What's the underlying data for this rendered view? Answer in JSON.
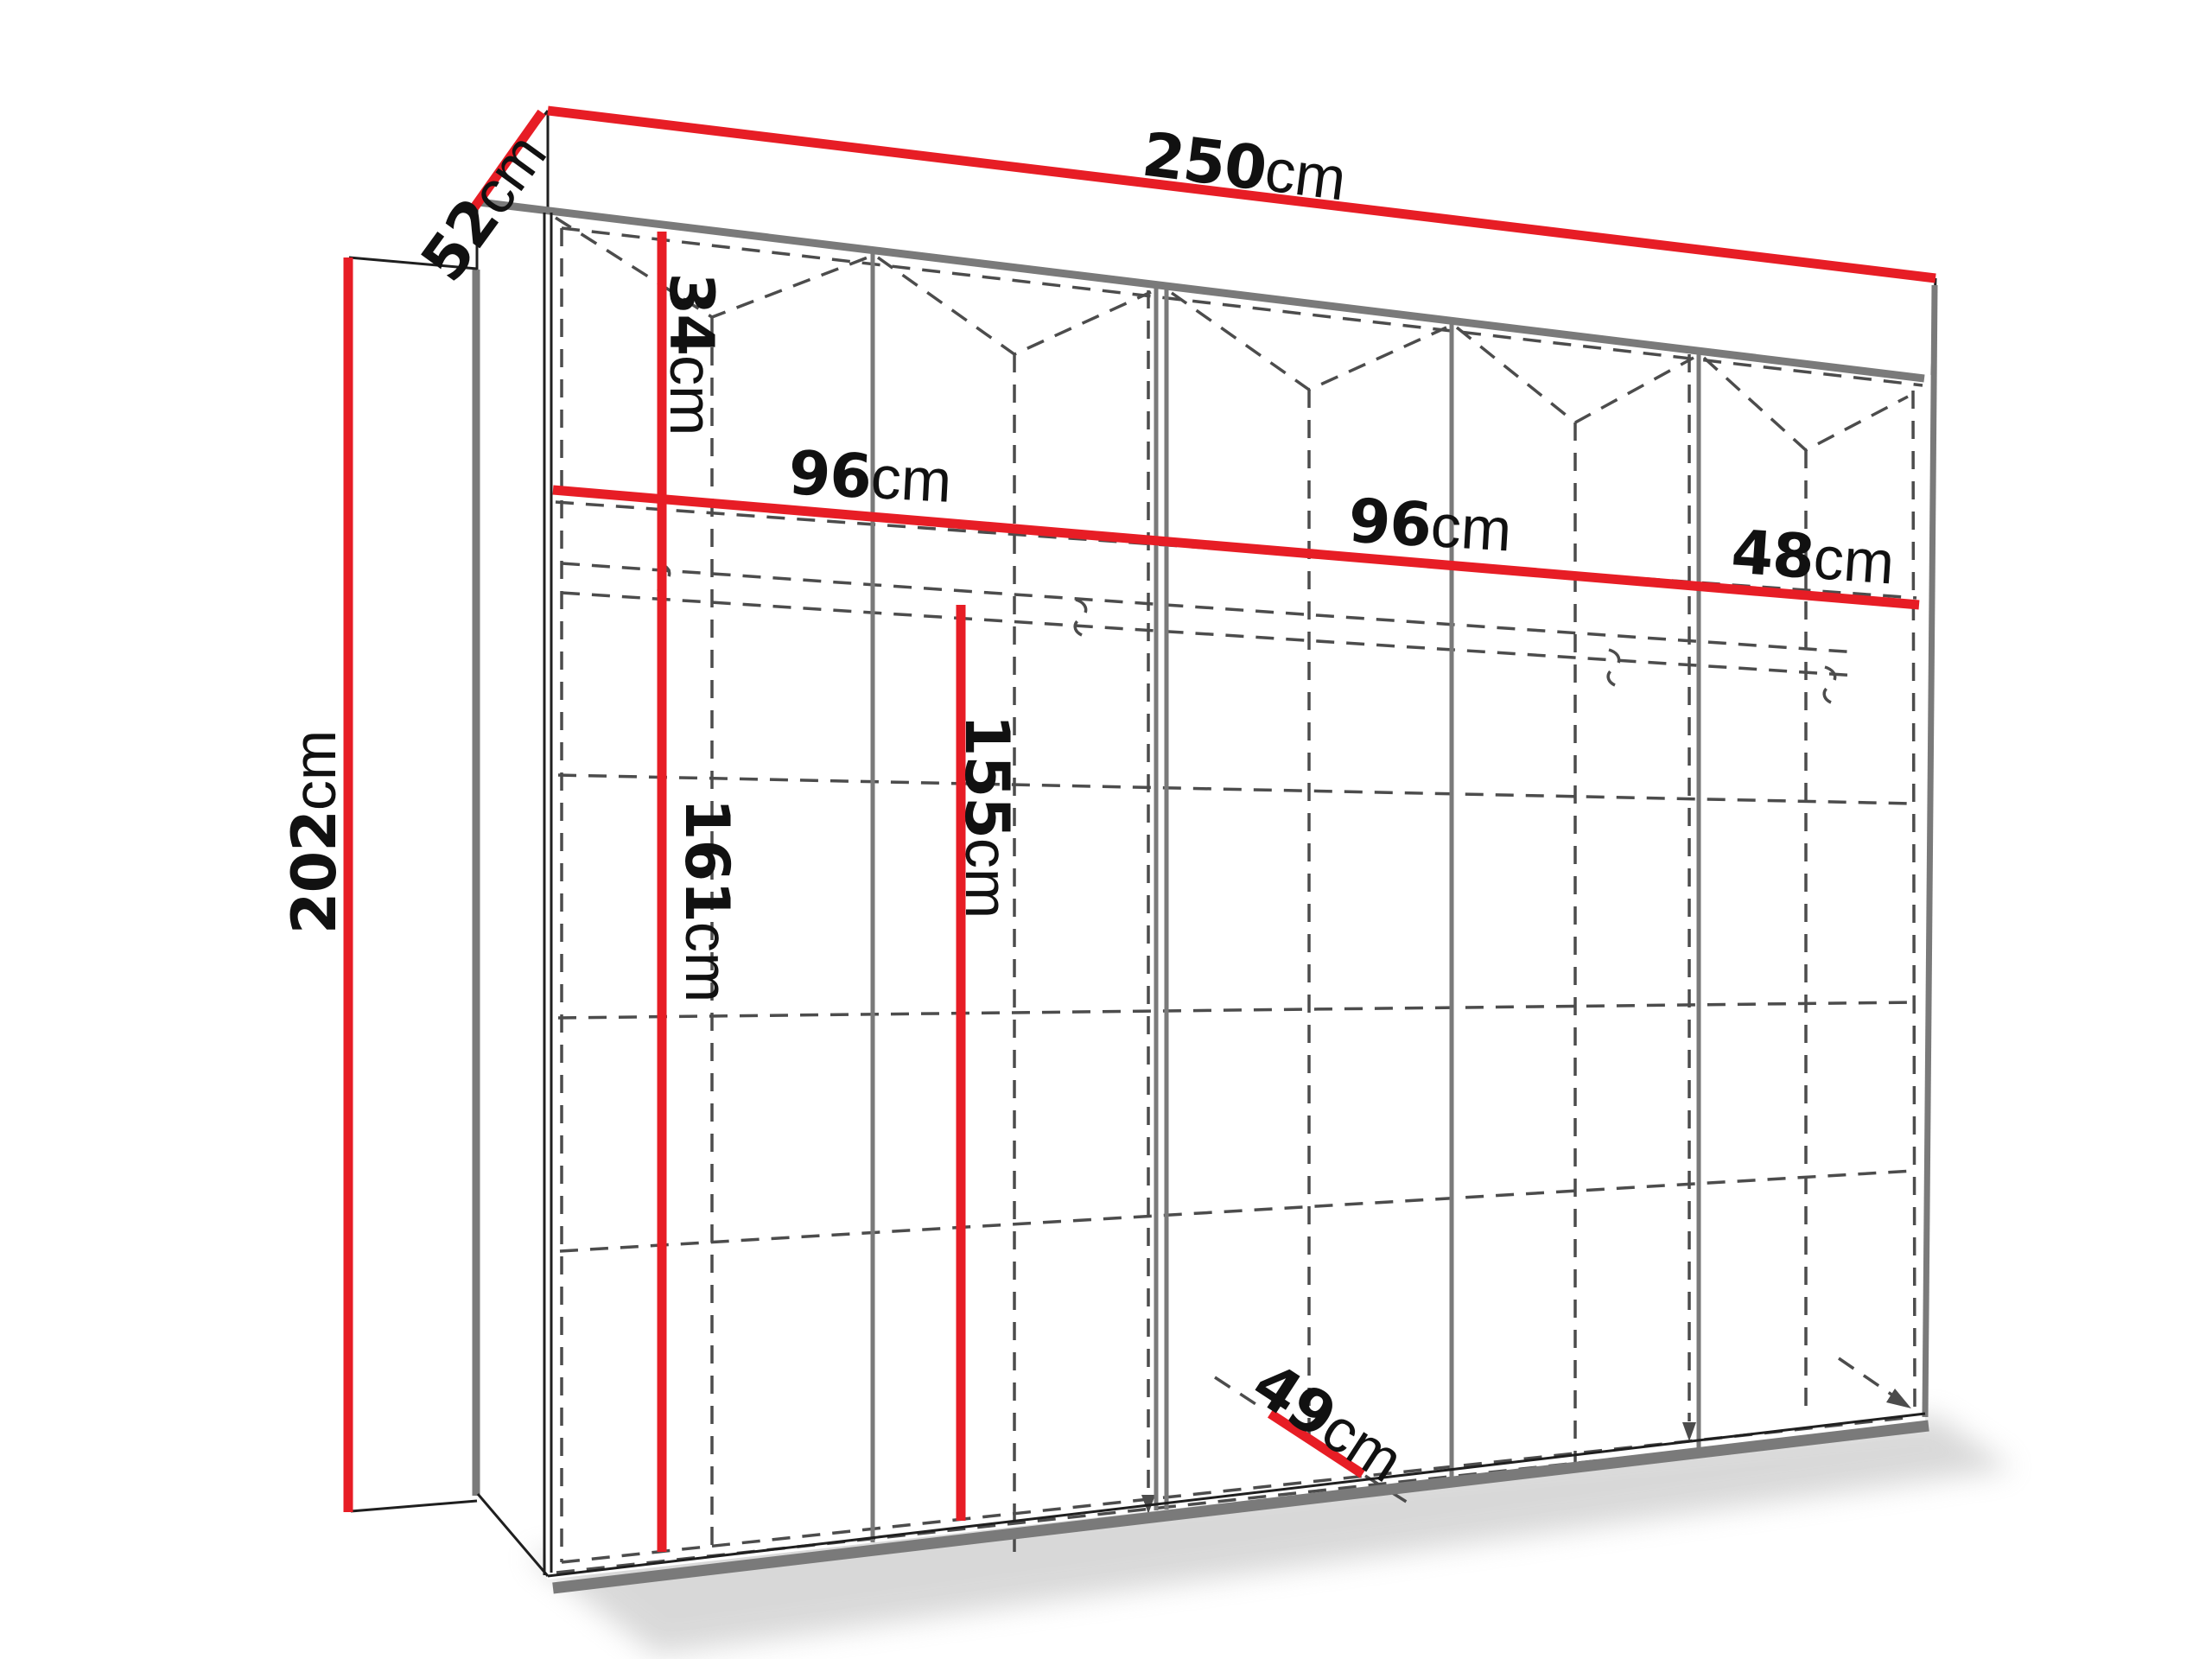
{
  "colors": {
    "accent": "#e71d25",
    "edge": "#1f1f1f",
    "panel": "#7a7a7a",
    "dash": "#4c4c4c",
    "label": "#111111"
  },
  "diagram": {
    "name": "wardrobe-dimension-drawing",
    "labels": {
      "width_total": {
        "value": "250",
        "unit": "cm"
      },
      "depth_top": {
        "value": "52",
        "unit": "cm"
      },
      "height_total": {
        "value": "202",
        "unit": "cm"
      },
      "top_section_height": {
        "value": "34",
        "unit": "cm"
      },
      "left_section_width": {
        "value": "96",
        "unit": "cm"
      },
      "middle_section_width": {
        "value": "96",
        "unit": "cm"
      },
      "right_section_width": {
        "value": "48",
        "unit": "cm"
      },
      "left_inner_height": {
        "value": "161",
        "unit": "cm"
      },
      "middle_inner_height": {
        "value": "155",
        "unit": "cm"
      },
      "bottom_inner_depth": {
        "value": "49",
        "unit": "cm"
      }
    }
  }
}
